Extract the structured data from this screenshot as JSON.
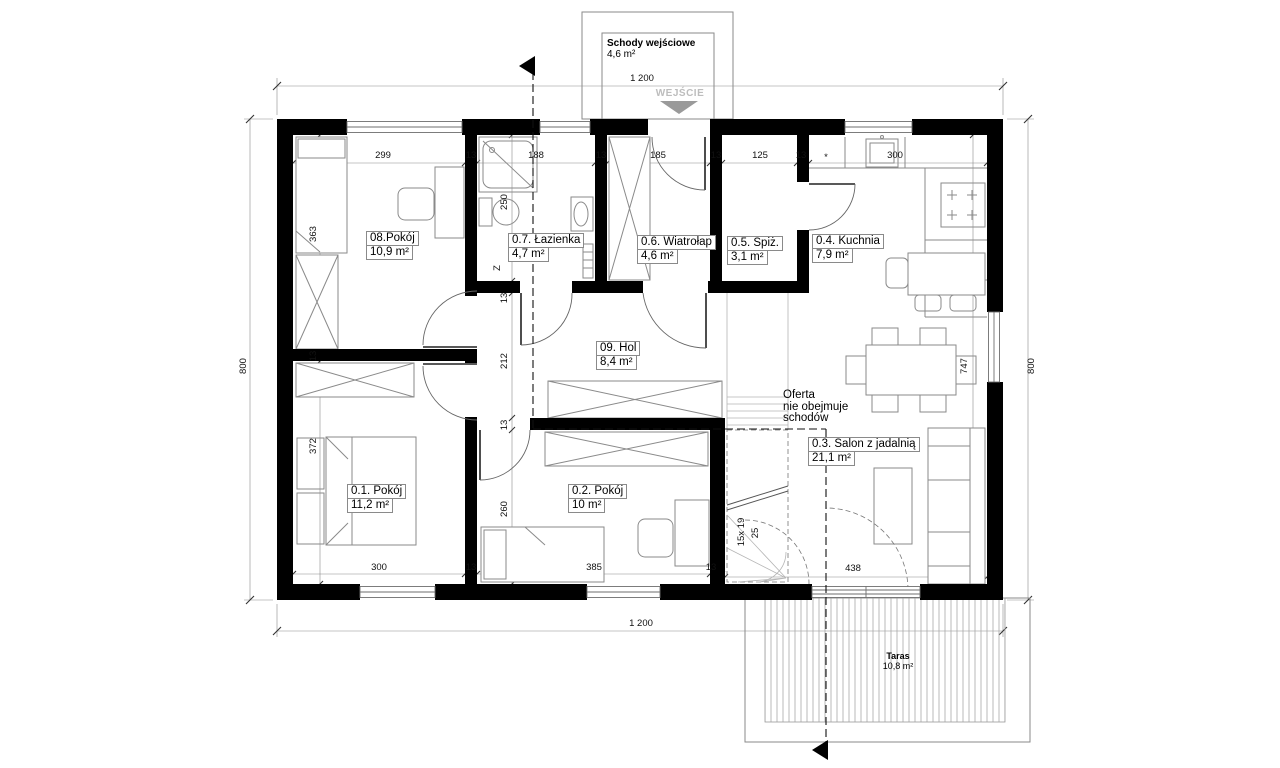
{
  "entry": {
    "label": "Schody wejściowe",
    "area": "4,6 m²",
    "direction": "WEJŚCIE"
  },
  "rooms": {
    "r08": {
      "name": "08.Pokój",
      "area": "10,9 m²"
    },
    "r07": {
      "name": "0.7. Łazienka",
      "area": "4,7 m²"
    },
    "r06": {
      "name": "0.6. Wiatrołap",
      "area": "4,6 m²"
    },
    "r05": {
      "name": "0.5. Spiż.",
      "area": "3,1 m²"
    },
    "r04": {
      "name": "0.4. Kuchnia",
      "area": "7,9 m²"
    },
    "r09": {
      "name": "09. Hol",
      "area": "8,4 m²"
    },
    "r01": {
      "name": "0.1. Pokój",
      "area": "11,2 m²"
    },
    "r02": {
      "name": "0.2. Pokój",
      "area": "10 m²"
    },
    "r03": {
      "name": "0.3. Salon z jadalnią",
      "area": "21,1 m²"
    },
    "taras": {
      "name": "Taras",
      "area": "10,8 m²"
    }
  },
  "note": {
    "line1": "Oferta",
    "line2": "nie obejmuje",
    "line3": "schodów"
  },
  "stairs": {
    "count_label": "15x 19",
    "width_label": "25"
  },
  "bath": {
    "appliance_label": "Z"
  },
  "dims": {
    "top_total": "1 200",
    "bottom_total": "1 200",
    "left_total": "800",
    "right_total": "800",
    "top_row": [
      "299",
      "13",
      "188",
      "13",
      "185",
      "13",
      "125",
      "13",
      "*",
      "300"
    ],
    "left_col": [
      "363",
      "13",
      "372"
    ],
    "center_col": [
      "250",
      "13",
      "212",
      "13",
      "260"
    ],
    "bottom_row": [
      "300",
      "13",
      "385",
      "13"
    ],
    "salon_height": "747",
    "salon_door_width": "438"
  },
  "colors": {
    "wall": "#000000",
    "furniture_line": "#8a8a8a",
    "entry_gray": "#bdbdbd"
  }
}
